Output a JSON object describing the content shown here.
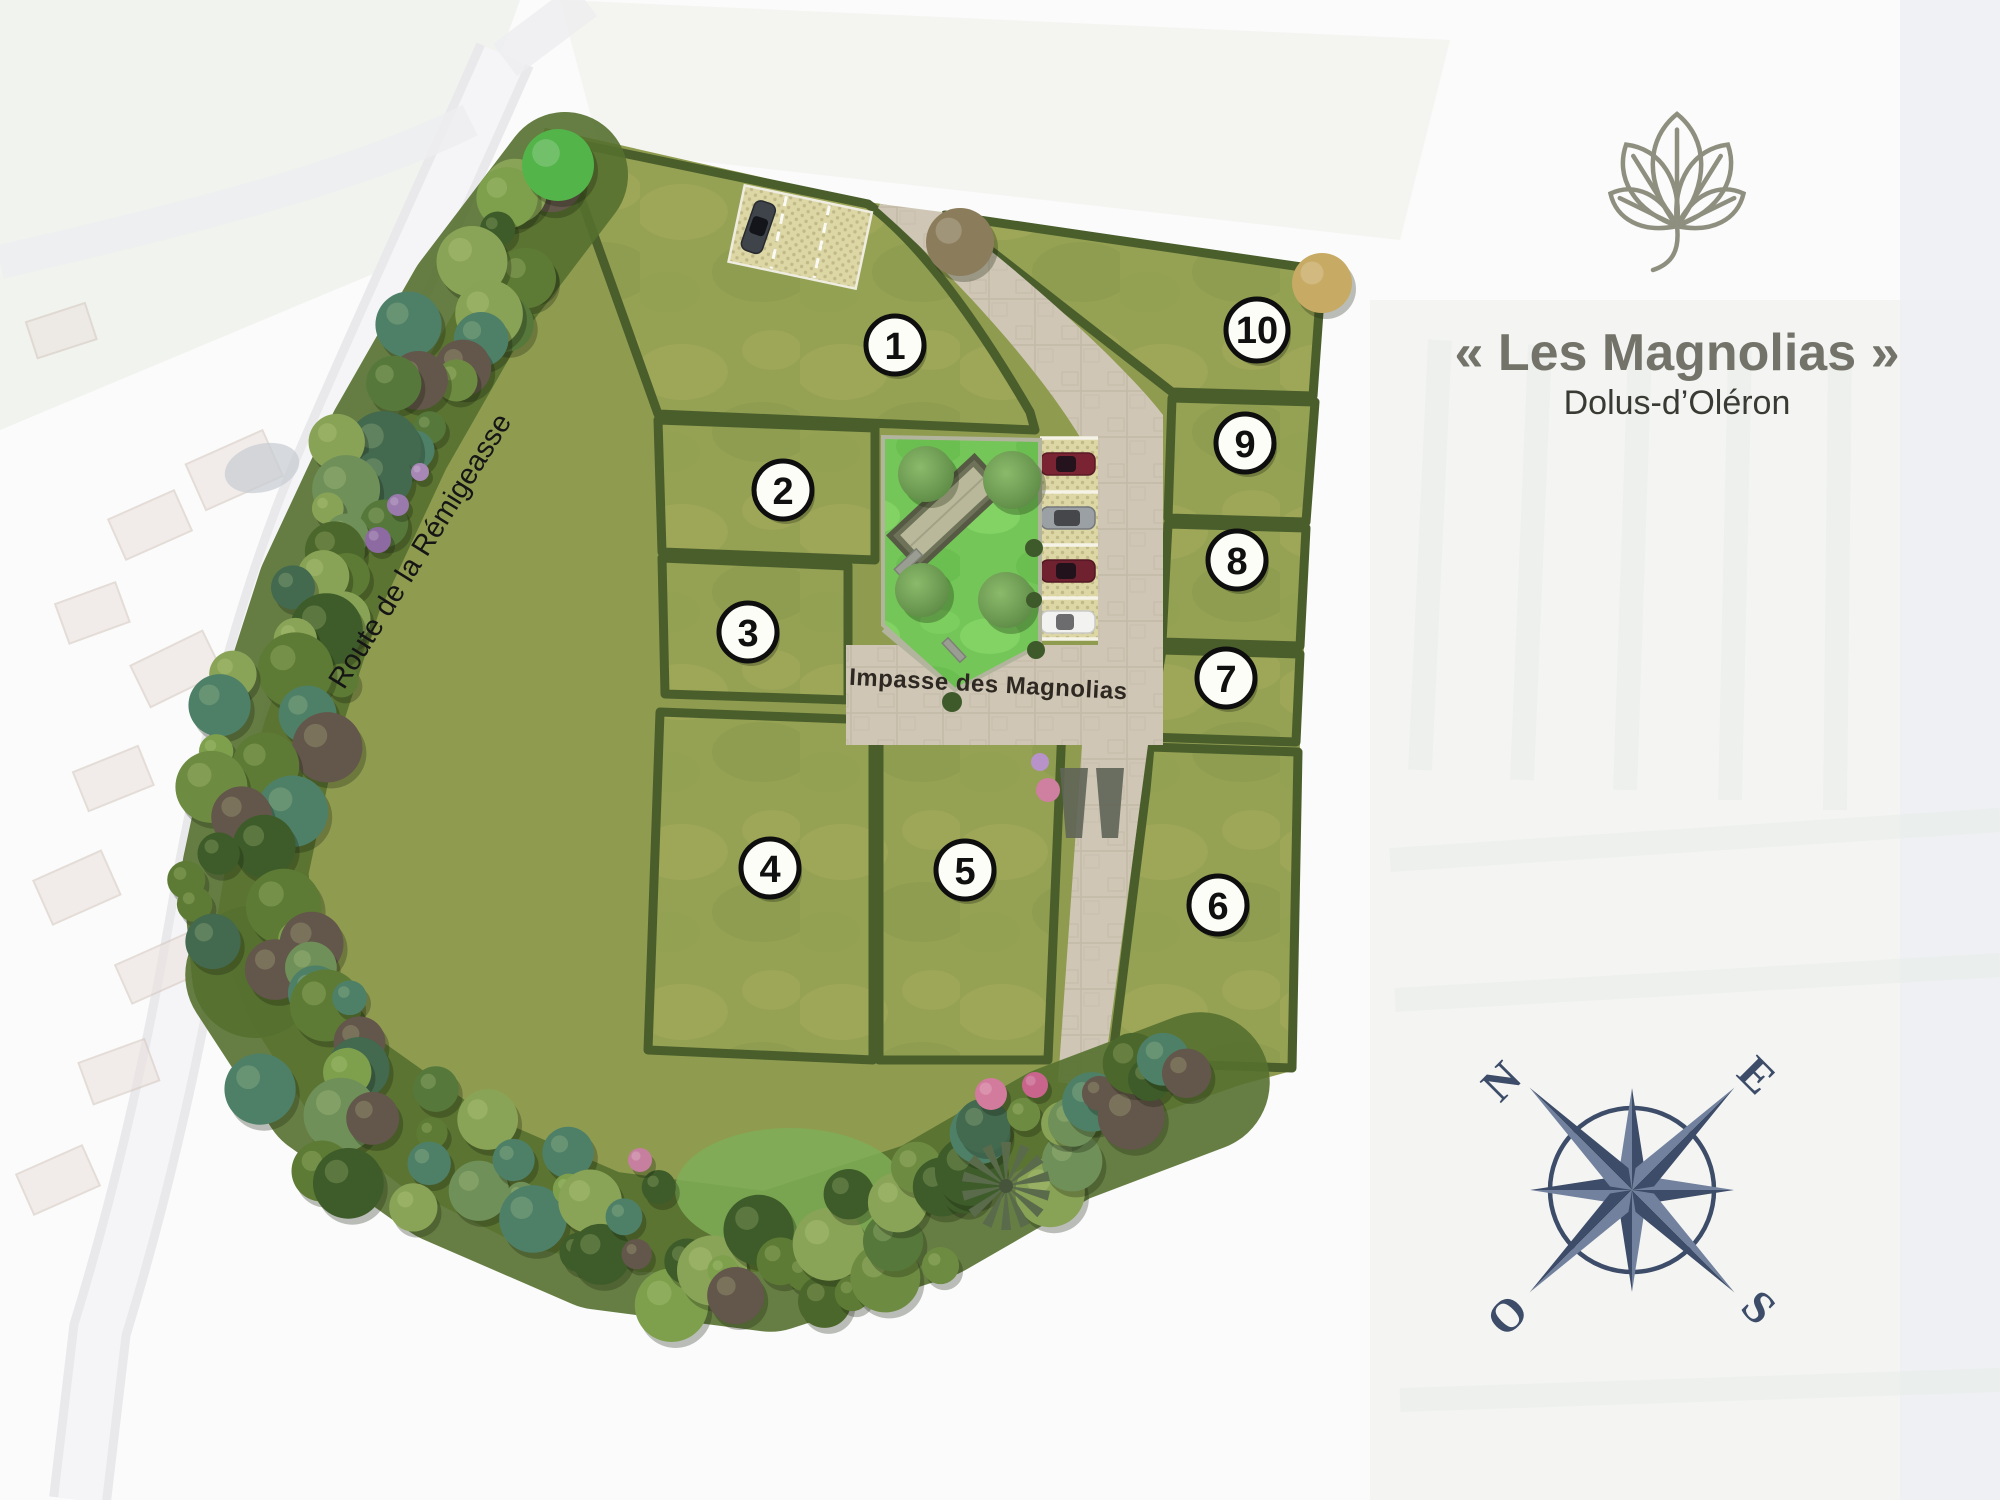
{
  "branding": {
    "logo_icon": "magnolia-leaf-icon",
    "title": "« Les Magnolias »",
    "subtitle": "Dolus-d’Oléron"
  },
  "map_labels": {
    "boundary_road": "Route de la Rémigeasse",
    "internal_street": "Impasse des Magnolias"
  },
  "lots": [
    {
      "number": "1"
    },
    {
      "number": "2"
    },
    {
      "number": "3"
    },
    {
      "number": "4"
    },
    {
      "number": "5"
    },
    {
      "number": "6"
    },
    {
      "number": "7"
    },
    {
      "number": "8"
    },
    {
      "number": "9"
    },
    {
      "number": "10"
    }
  ],
  "compass": {
    "n": "N",
    "e": "E",
    "s": "S",
    "o": "O"
  },
  "palette": {
    "title_text": "#73736a",
    "subtitle_text": "#3a3a35",
    "compass_blue": "#3d4c68",
    "lot_grass": "#95a153",
    "common_lawn": "#74c658",
    "hedge_green": "#4a5e2c",
    "paving": "#cfc6b5",
    "parking_sand": "#ddd7a6"
  }
}
